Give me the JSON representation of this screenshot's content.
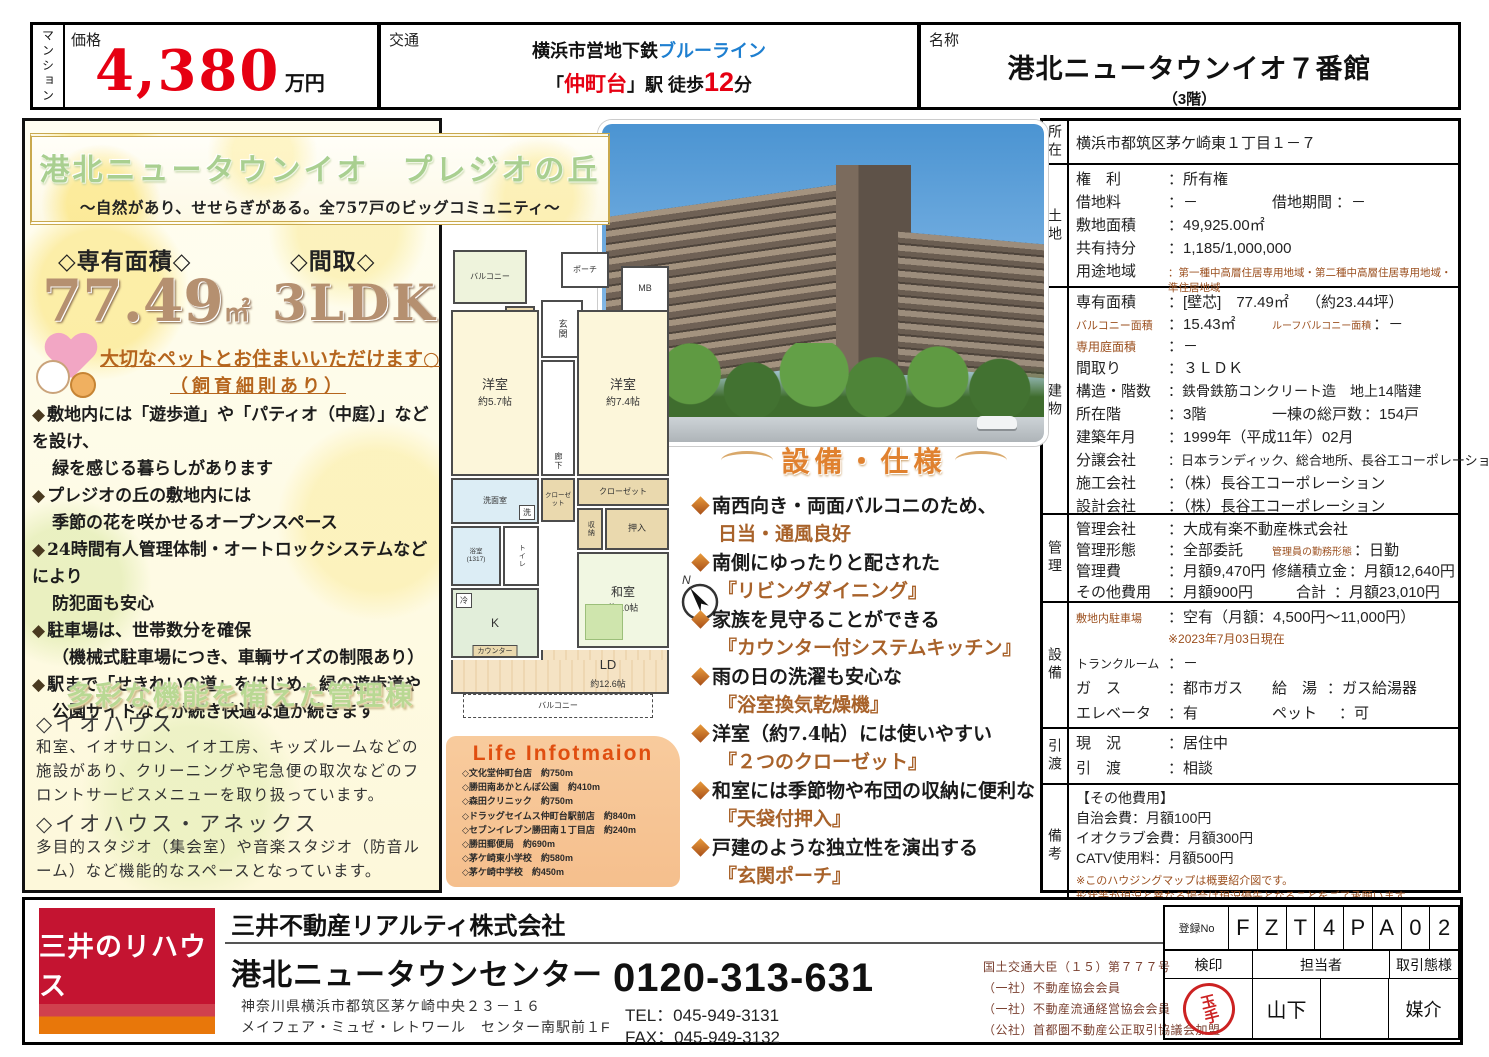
{
  "colors": {
    "price_red": "#e60012",
    "blue_line": "#1e7fd0",
    "accent_brown": "#a8622a",
    "heading_orange": "#e0812f",
    "title_green": "#a9cf90",
    "logo_red": "#c41431",
    "logo_orange": "#e8770a",
    "stamp_red": "#cc2222"
  },
  "header": {
    "property_type": "マンション",
    "price_label": "価格",
    "price_value": "4,380",
    "price_unit": "万円",
    "access_label": "交通",
    "access_rail": "横浜市営地下鉄",
    "access_line": "ブルーライン",
    "access_q1": "「",
    "access_station": "仲町台",
    "access_q2": "」駅 徒歩",
    "access_minutes": "12",
    "access_min_unit": "分",
    "name_label": "名称",
    "name_value": "港北ニュータウンイオ７番館",
    "name_floor": "（3階）"
  },
  "left_panel": {
    "title": "港北ニュータウンイオ　プレジオの丘",
    "subtitle": "〜自然があり、せせらぎがある。全757戸のビッグコミュニティ〜",
    "area_label": "◇専有面積◇",
    "area_value": "77.49",
    "area_unit": "㎡",
    "layout_label": "◇間取◇",
    "layout_value": "3LDK",
    "pet_line1": "大切なペットとお住まいいただけます○",
    "pet_line2": "（飼育細則あり）",
    "bullets": [
      {
        "l1": "敷地内には「遊歩道」や「パティオ（中庭）」などを設け、",
        "l2": "緑を感じる暮らしがあります"
      },
      {
        "l1": "プレジオの丘の敷地内には",
        "l2": "季節の花を咲かせるオープンスペース"
      },
      {
        "l1": "24時間有人管理体制・オートロックシステムなどにより",
        "l2": "防犯面も安心"
      },
      {
        "l1": "駐車場は、世帯数分を確保",
        "l2": "（機械式駐車場につき、車輌サイズの制限あり）"
      },
      {
        "l1": "駅まで「せきれいの道」をはじめ、緑の遊歩道や",
        "l2": "公園サイドなどが続き快適な道が続きます"
      }
    ],
    "green_heading": "多彩な機能を備えた管理棟",
    "iohouse_title": "◇イオハウス",
    "iohouse_text": "和室、イオサロン、イオ工房、キッズルームなどの施設があり、クリーニングや宅急便の取次などのフロントサービスメニューを取り扱っています。",
    "annex_title": "◇イオハウス・アネックス",
    "annex_text": "多目的スタジオ（集会室）や音楽スタジオ（防音ルーム）など機能的なスペースとなっています。"
  },
  "floorplan": {
    "balcony_top": "バルコニー",
    "porch": "ポーチ",
    "mb": "MB",
    "entrance": "玄関",
    "shoe": "下足入",
    "west1": "洋室",
    "west1_size": "約5.7帖",
    "hall": "廊下",
    "west2": "洋室",
    "west2_size": "約7.4帖",
    "closet_a": "クローゼット",
    "closet_b": "クローゼット",
    "storage": "収納",
    "oshiire": "押入",
    "wash": "洗面室",
    "washer": "洗",
    "bath": "浴室",
    "bath_size": "(1317)",
    "fridge": "冷",
    "kitchen": "K",
    "counter": "カウンター",
    "washitsu": "和室",
    "washitsu_size": "約6.0帖",
    "ld": "LD",
    "ld_size": "約12.6帖",
    "balcony_bottom": "バルコニー",
    "compass_n": "N"
  },
  "equipment": {
    "heading": "設備・仕様",
    "items": [
      {
        "l1": "南西向き・両面バルコニのため、",
        "l2": "日当・通風良好"
      },
      {
        "l1": "南側にゆったりと配された",
        "l2": "『リビングダイニング』"
      },
      {
        "l1": "家族を見守ることができる",
        "l2": "『カウンター付システムキッチン』"
      },
      {
        "l1": "雨の日の洗濯も安心な",
        "l2": "『浴室換気乾燥機』"
      },
      {
        "l1": "洋室（約7.4帖）には使いやすい",
        "l2": "『２つのクローゼット』"
      },
      {
        "l1": "和室には季節物や布団の収納に便利な",
        "l2": "『天袋付押入』"
      },
      {
        "l1": "戸建のような独立性を演出する",
        "l2": "『玄関ポーチ』"
      }
    ]
  },
  "life_info": {
    "title": "Life Infotmaion",
    "items": [
      "◇文化堂仲町台店　約750m",
      "◇勝田南あかとんぼ公園　約410m",
      "◇森田クリニック　約750m",
      "◇ドラッグセイムス仲町台駅前店　約840m",
      "◇セブンイレブン勝田南１丁目店　約240m",
      "◇勝田郵便局　約690m",
      "◇茅ケ崎東小学校　約580m",
      "◇茅ケ崎中学校　約450m"
    ]
  },
  "details": {
    "shozai_label": "所在",
    "shozai_value": "横浜市都筑区茅ケ崎東１丁目１－７",
    "tochi_label": "土地",
    "tochi": [
      {
        "k": "権　利",
        "v": "：所有権"
      },
      {
        "k": "借地料",
        "v": "：－",
        "k2": "借地期間",
        "v2": "：－"
      },
      {
        "k": "敷地面積",
        "v": "：49,925.00㎡"
      },
      {
        "k": "共有持分",
        "v": "：1,185/1,000,000"
      },
      {
        "k": "用途地域",
        "v": "：第一種中高層住居専用地域・第二種中高層住居専用地域・準住居地域"
      }
    ],
    "tatemono_label": "建物",
    "tatemono": [
      {
        "k": "専有面積",
        "v": "：[壁芯]　77.49㎡",
        "v2": "（約23.44坪）"
      },
      {
        "k": "バルコニー面積",
        "v": "：15.43㎡",
        "k2": "ルーフバルコニー面積",
        "v2b": "：－"
      },
      {
        "k": "専用庭面積",
        "v": "：－"
      },
      {
        "k": "間取り",
        "v": "：３ＬＤＫ"
      },
      {
        "k": "構造・階数",
        "v": "：鉄骨鉄筋コンクリート造　地上14階建"
      },
      {
        "k": "所在階",
        "v": "：3階",
        "k2": "一棟の総戸数",
        "v2": "：154戸"
      },
      {
        "k": "建築年月",
        "v": "：1999年（平成11年）02月"
      },
      {
        "k": "分譲会社",
        "v": "：日本ランディック、総合地所、長谷工コーポレーション"
      },
      {
        "k": "施工会社",
        "v": "：（株）長谷工コーポレーション"
      },
      {
        "k": "設計会社",
        "v": "：（株）長谷工コーポレーション"
      }
    ],
    "kanri_label": "管理",
    "kanri": [
      {
        "k": "管理会社",
        "v": "：大成有楽不動産株式会社"
      },
      {
        "k": "管理形態",
        "v": "：全部委託",
        "k2": "管理員の勤務形態",
        "v2": "：日勤"
      },
      {
        "k": "管理費",
        "v": "：月額9,470円",
        "k2": "修繕積立金",
        "v2": "：月額12,640円"
      },
      {
        "k": "その他費用",
        "v": "：月額900円",
        "k2": "合計",
        "v2": "：月額23,010円"
      }
    ],
    "setsubi_label": "設備",
    "setsubi_r1k": "敷地内駐車場",
    "setsubi_r1v": "：空有（月額：4,500円〜11,000円）",
    "setsubi_note": "※2023年7月03日現在",
    "setsubi_r2k": "トランクルーム",
    "setsubi_r2v": "：－",
    "setsubi_r3k": "ガ　ス",
    "setsubi_r3v": "：都市ガス",
    "setsubi_r3k2": "給　湯",
    "setsubi_r3v2": "：ガス給湯器",
    "setsubi_r4k": "エレベータ",
    "setsubi_r4v": "：有",
    "setsubi_r4k2": "ペット",
    "setsubi_r4v2": "：可",
    "hikiwatashi_label": "引渡",
    "hikiwatashi": [
      {
        "k": "現　況",
        "v": "：居住中"
      },
      {
        "k": "引　渡",
        "v": "：相談"
      }
    ],
    "biko_label": "備考",
    "biko_lines": [
      "【その他費用】",
      "自治会費：月額100円",
      "イオクラブ会費：月額300円",
      "CATV使用料：月額500円"
    ],
    "biko_notes": [
      "※このハウジングマップは概要紹介図です。",
      "形状等が現況と異なる場合は現況優先となることをご了承願います。"
    ]
  },
  "footer": {
    "logo": "三井のリハウス",
    "company": "三井不動産リアルティ株式会社",
    "center_name": "港北ニュータウンセンター",
    "address1": "神奈川県横浜市都筑区茅ケ崎中央２３－１６",
    "address2": "メイフェア・ミュゼ・レトワール　センター南駅前１F",
    "phone": "0120-313-631",
    "tel": "TEL：045-949-3131",
    "fax": "FAX：045-949-3132",
    "licenses": [
      "国土交通大臣（１５）第７７７号",
      "（一社）不動産協会会員",
      "（一社）不動産流通経営協会会員",
      "（公社）首都圏不動産公正取引協議会加盟"
    ],
    "reg_label": "登録No",
    "reg_digits": [
      "F",
      "Z",
      "T",
      "4",
      "P",
      "A",
      "0",
      "2"
    ],
    "kenin_label": "検印",
    "tantosha_label": "担当者",
    "torihiki_label": "取引態様",
    "stamp": "玉手",
    "staff": "山下",
    "trade_type": "媒介"
  }
}
